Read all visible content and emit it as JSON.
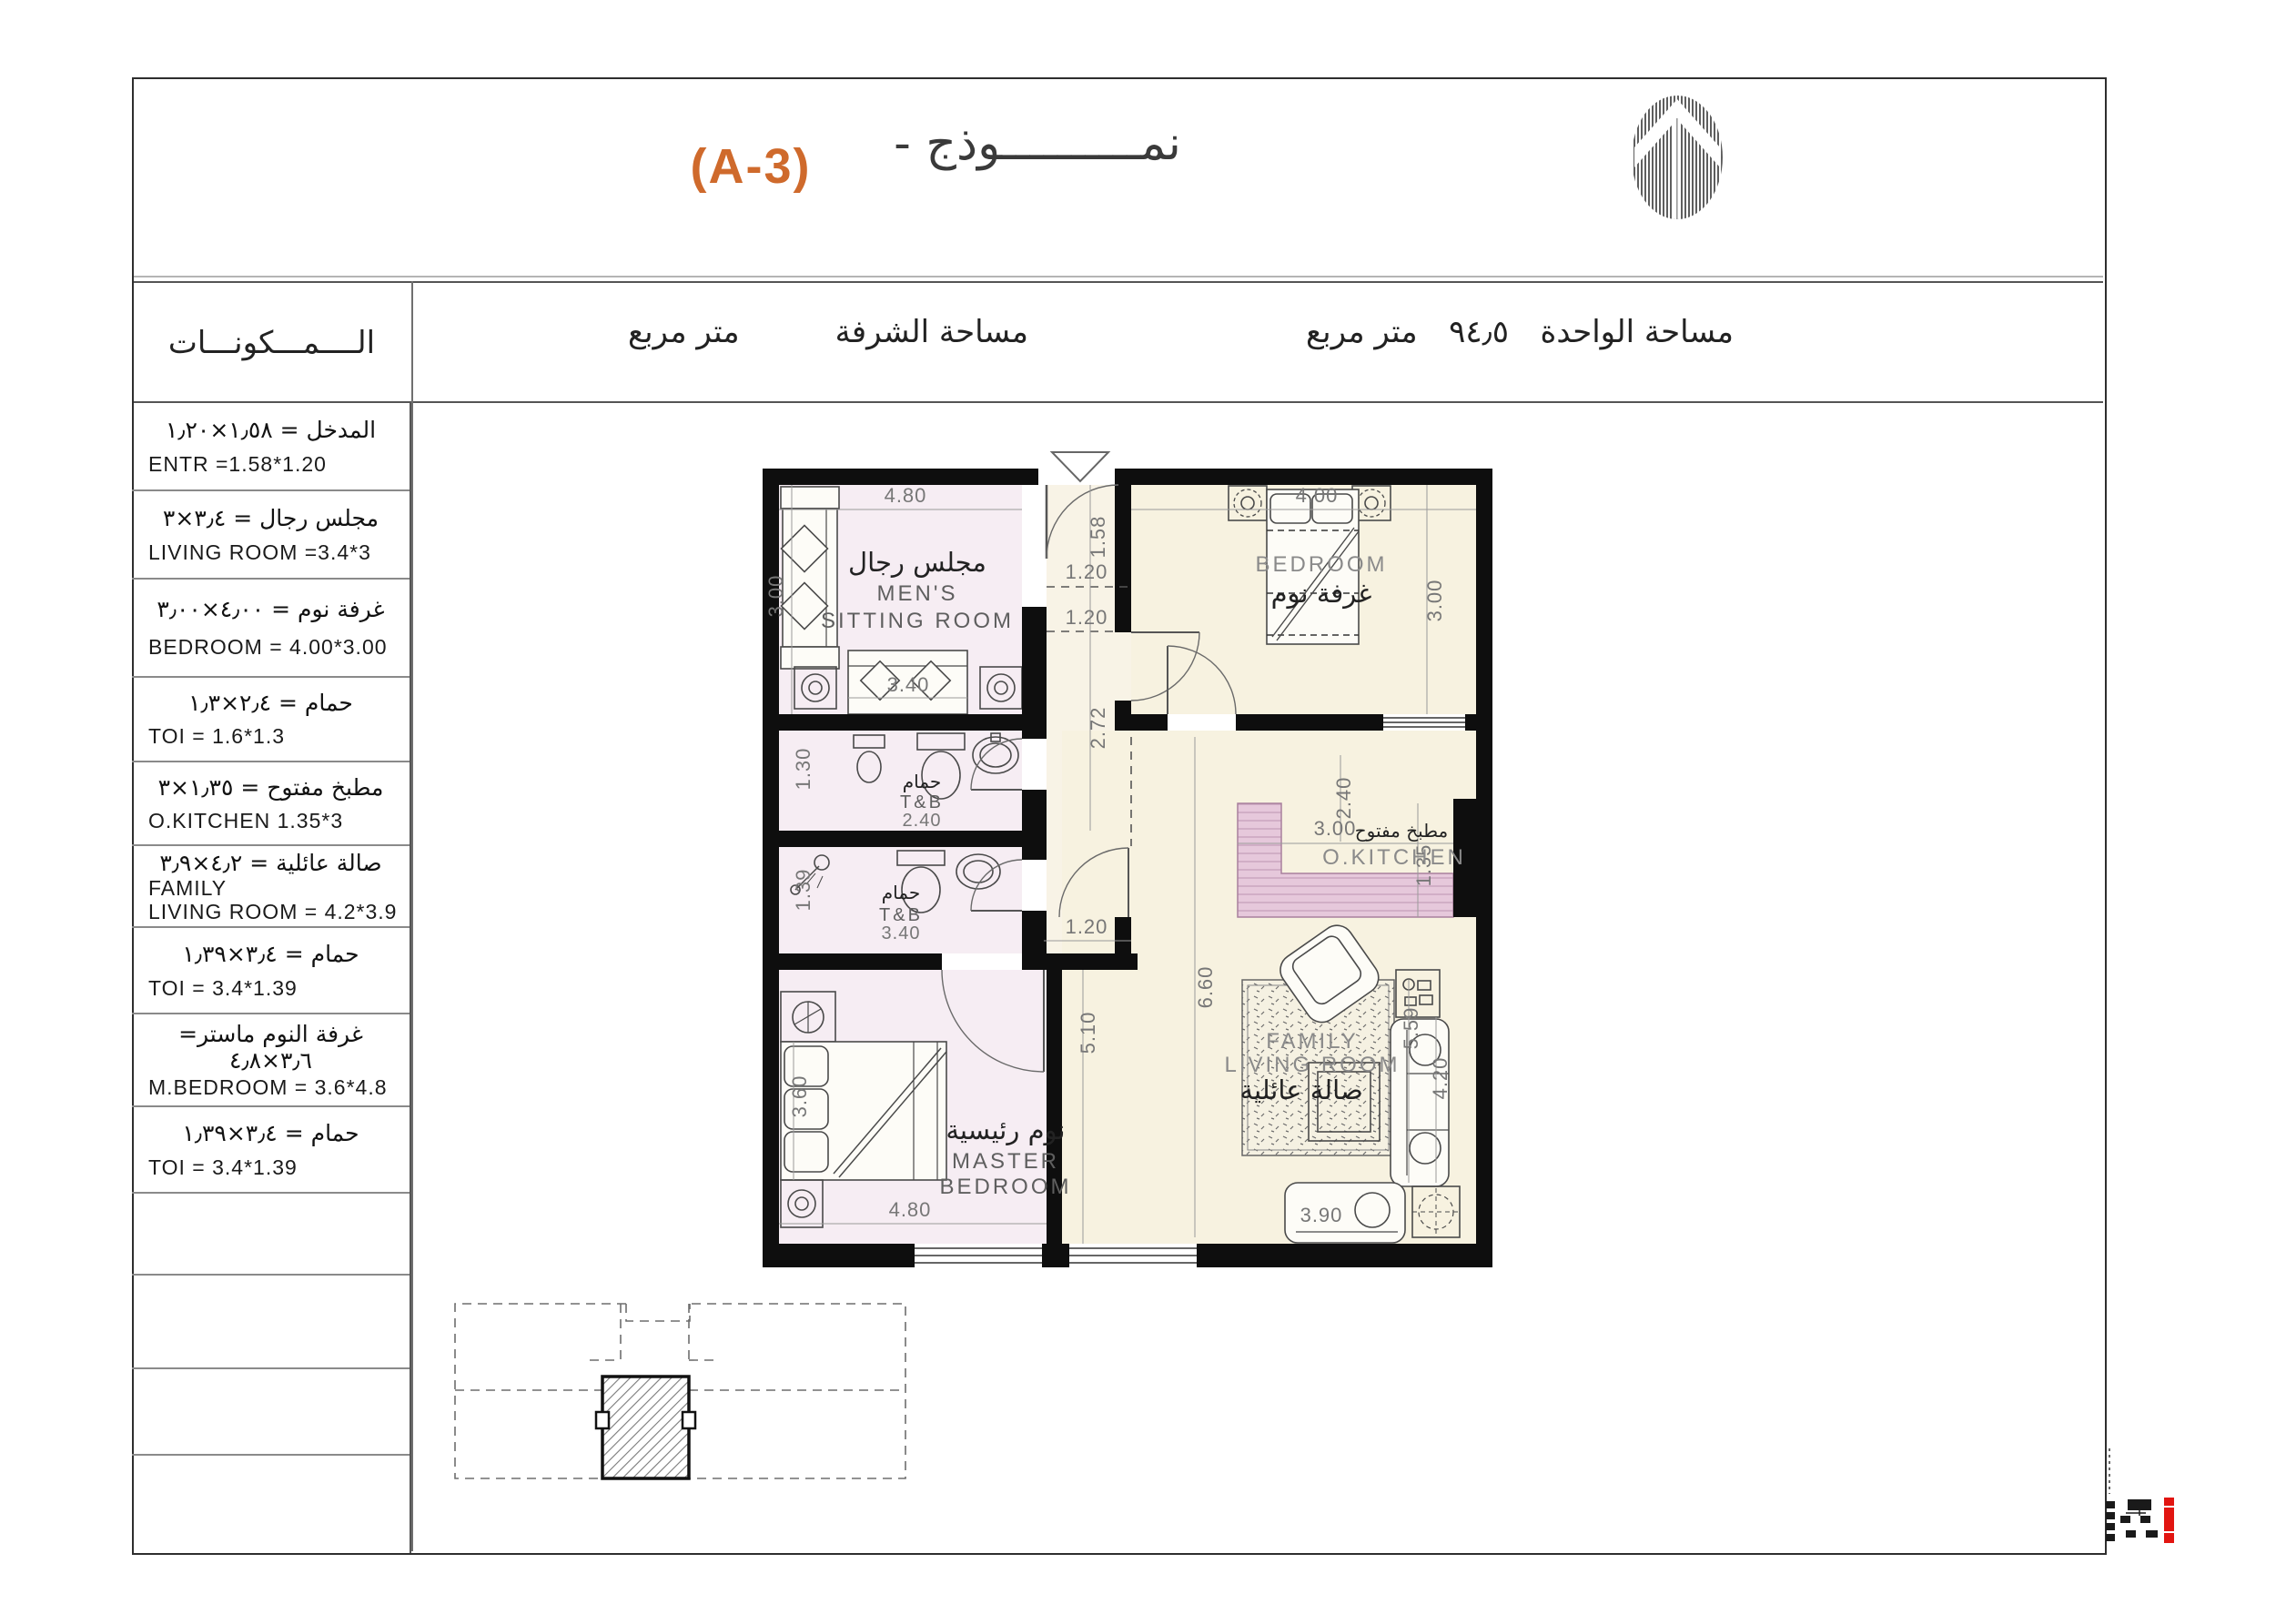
{
  "title": {
    "model_ar": "نمــــــــــوذج -",
    "code": "(A-3)",
    "accent_color": "#cf6a2c"
  },
  "header": {
    "components": "الــــمـــكونـــات",
    "balcony_label": "مساحة الشرفة",
    "balcony_unit": "متر مربع",
    "unit_label": "مساحة الواحدة",
    "unit_value": "٩٤٫٥",
    "unit_unit": "متر مربع"
  },
  "table": {
    "rows": [
      {
        "ar": "المدخل = ١٫٥٨×١٫٢٠",
        "en": "ENTR =1.58*1.20"
      },
      {
        "ar": "مجلس رجال  =  ٣٫٤×٣",
        "en": "LIVING ROOM =3.4*3"
      },
      {
        "ar": "غرفة نوم = ٤٫٠٠×٣٫٠٠",
        "en": "BEDROOM  =  4.00*3.00"
      },
      {
        "ar": "حمام = ٢٫٤×١٫٣",
        "en": "TOI  =  1.6*1.3"
      },
      {
        "ar": "مطبخ مفتوح =  ١٫٣٥×٣",
        "en": "O.KITCHEN  1.35*3"
      },
      {
        "ar": "صالة عائلية  =  ٤٫٢×٣٫٩",
        "en": "FAMILY\nLIVING ROOM =  4.2*3.9"
      },
      {
        "ar": "حمام = ٣٫٤×١٫٣٩",
        "en": "TOI  =  3.4*1.39"
      },
      {
        "ar": "غرفة النوم ماستر= ٣٫٦×٤٫٨",
        "en": "M.BEDROOM  =  3.6*4.8"
      },
      {
        "ar": "حمام = ٣٫٤×١٫٣٩",
        "en": "TOI  =  3.4*1.39"
      }
    ]
  },
  "plan": {
    "labels": {
      "mens_ar": "مجلس رجال",
      "mens_en1": "MEN'S",
      "mens_en2": "SITTING ROOM",
      "bedroom_en": "BEDROOM",
      "bedroom_ar": "غرفة نوم",
      "tb1_ar": "حمام",
      "tb1_en": "T&B",
      "tb1_size": "2.40",
      "tb2_ar": "حمام",
      "tb2_en": "T&B",
      "tb2_size": "3.40",
      "kitchen_ar": "مطبخ مفتوح",
      "kitchen_en": "O.KITCHEN",
      "family_en1": "FAMILY",
      "family_en2": "LIVING ROOM",
      "family_ar": "صالة عائلية",
      "master_ar": "نوم رئيسية",
      "master_en1": "MASTER",
      "master_en2": "BEDROOM"
    },
    "dims": {
      "entry": "1.58",
      "sitting_w": "4.80",
      "sitting_d": "3.00",
      "sofa": "3.40",
      "pass1": "1.20",
      "pass2": "1.20",
      "corridor": "2.72",
      "tb1_w": "1.30",
      "tb2_w": "1.39",
      "bedroom_w": "4.00",
      "bedroom_d": "3.00",
      "hall": "2.40",
      "kitchen_w": "3.00",
      "kitchen_d": "1.35",
      "living_l": "6.60",
      "living_l2": "5.59",
      "sofa_r": "4.20",
      "clear": "5.10",
      "mdoor": "1.20",
      "master_w": "4.80",
      "master_d": "3.60",
      "sofa_b": "3.90"
    },
    "colors": {
      "room_pink": "#f6edf3",
      "room_cream": "#f7f2e0",
      "counter_pink": "#e6c8db",
      "wall": "#0e0e0e",
      "stamp_red": "#e21511"
    }
  }
}
